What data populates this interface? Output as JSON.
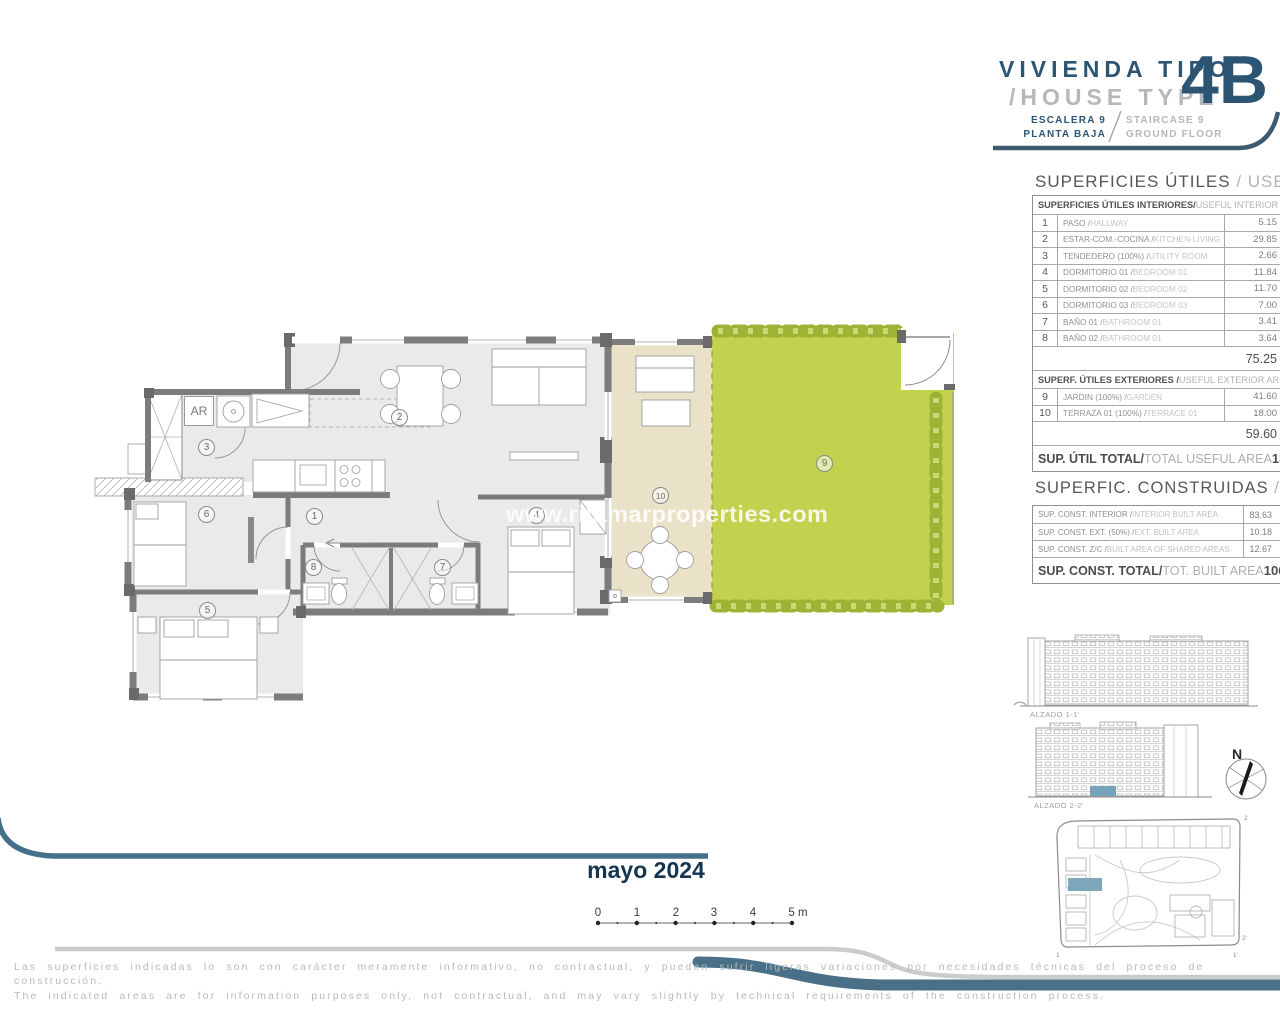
{
  "title_block": {
    "line1": "VIVIENDA TIPO",
    "line2": "/HOUSE TYPE",
    "code": "4B",
    "escalera_es": "ESCALERA 9",
    "planta_es": "PLANTA BAJA",
    "escalera_en": "STAIRCASE 9",
    "planta_en": "GROUND FLOOR"
  },
  "useful": {
    "title_es": "SUPERFICIES ÚTILES ",
    "title_en": "/ USEFUL AREA",
    "int_header_es": "SUPERFICIES ÚTILES INTERIORES/",
    "int_header_en": " USEFUL INTERIOR AREA",
    "rows": [
      {
        "num": "1",
        "es": "PASO / ",
        "en": "HALLWAY",
        "value": "5.15"
      },
      {
        "num": "2",
        "es": "ESTAR-COM.-COCINA / ",
        "en": "KITCHEN-LIVING",
        "value": "29.85"
      },
      {
        "num": "3",
        "es": "TENDEDERO (100%) / ",
        "en": "UTILITY ROOM",
        "value": "2.66"
      },
      {
        "num": "4",
        "es": "DORMITORIO 01 / ",
        "en": "BEDROOM 01",
        "value": "11.84"
      },
      {
        "num": "5",
        "es": "DORMITORIO 02 / ",
        "en": "BEDROOM 02",
        "value": "11.70"
      },
      {
        "num": "6",
        "es": "DORMITORIO 03 / ",
        "en": "BEDROOM 03",
        "value": "7.00"
      },
      {
        "num": "7",
        "es": "BAÑO 01 / ",
        "en": "BATHROOM 01",
        "value": "3.41"
      },
      {
        "num": "8",
        "es": "BAÑO 02 / ",
        "en": "BATHROOM 01",
        "value": "3.64"
      }
    ],
    "int_subtotal": "75.25",
    "ext_header_es": "SUPERF. ÚTILES EXTERIORES / ",
    "ext_header_en": "USEFUL EXTERIOR AREA",
    "ext_rows": [
      {
        "num": "9",
        "es": "JARDIN (100%) / ",
        "en": "GARDEN",
        "value": "41.60"
      },
      {
        "num": "10",
        "es": "TERRAZA 01 (100%) / ",
        "en": "TERRACE 01",
        "value": "18.00"
      }
    ],
    "ext_subtotal": "59.60",
    "total_es": "SUP. ÚTIL TOTAL/",
    "total_en": "TOTAL USEFUL AREA",
    "total_value": "134.85"
  },
  "built": {
    "title_es": "SUPERFIC. CONSTRUIDAS ",
    "title_en": "/BUILT AREA",
    "rows": [
      {
        "es": "SUP. CONST. INTERIOR /",
        "en": " INTERIOR BUILT AREA",
        "value": "83.63"
      },
      {
        "es": "SUP. CONST. EXT. (50%) /",
        "en": " EXT. BUILT AREA",
        "value": "10.18"
      },
      {
        "es": "SUP. CONST. Z/C /",
        "en": " BUILT AREA OF SHARED AREAS",
        "value": "12.67"
      }
    ],
    "total_es": "SUP. CONST. TOTAL/",
    "total_en": "TOT. BUILT AREA",
    "total_value": "106.49"
  },
  "plan": {
    "ar": "AR",
    "watermark": "www.ritamarproperties.com",
    "rooms": [
      {
        "num": "1"
      },
      {
        "num": "2"
      },
      {
        "num": "3"
      },
      {
        "num": "4"
      },
      {
        "num": "5"
      },
      {
        "num": "6"
      },
      {
        "num": "7"
      },
      {
        "num": "8"
      },
      {
        "num": "9"
      },
      {
        "num": "10"
      }
    ]
  },
  "elevations": {
    "label1": "ALZADO 1-1'",
    "label2": "ALZADO 2-2'",
    "north": "N"
  },
  "site_plan": {
    "markers": {
      "m1": "1",
      "m1p": "1'",
      "m2": "2",
      "m2p": "2'"
    }
  },
  "scale_bar": {
    "labels": [
      "0",
      "1",
      "2",
      "3",
      "4",
      "5 m"
    ]
  },
  "footer": {
    "date": "mayo 2024",
    "disclaimer_es": "Las superficies indicadas lo son con carácter meramente informativo, no contractual, y pueden sufrir ligeras variaciones por necesidades técnicas del proceso de construcción.",
    "disclaimer_en": "The indicated areas are for information purposes only, not contractual, and may vary slightly by technical requirements of the construction process."
  },
  "colors": {
    "navy": "#2b5572",
    "steel_swoosh": "#4a7087",
    "garden_green": "#c2d24f",
    "hedge_green": "#9db335",
    "terrace_beige": "#e9e1c8",
    "highlight_blue": "#74a3ba",
    "wall_gray": "#7c7c7c"
  }
}
